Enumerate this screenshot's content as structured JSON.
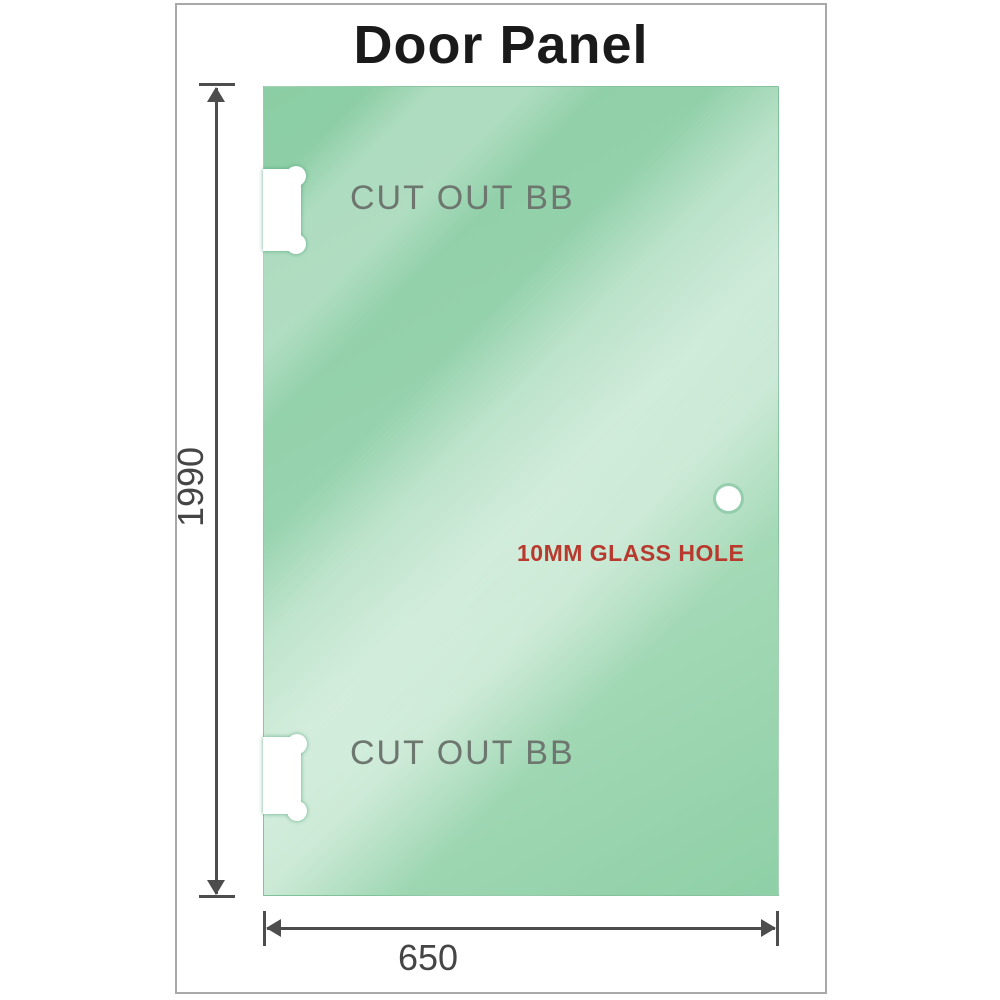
{
  "title": "Door Panel",
  "panel": {
    "cutout_top_label": "CUT OUT BB",
    "cutout_bottom_label": "CUT OUT BB",
    "hole_label": "10MM GLASS HOLE"
  },
  "dimensions": {
    "height": "1990",
    "width": "650"
  },
  "icons": {
    "dimension_arrows": [
      "arrow-up-icon",
      "arrow-down-icon",
      "arrow-left-icon",
      "arrow-right-icon"
    ]
  },
  "colors": {
    "glass_green_base": "#8bcda4",
    "glass_green_light": "#d2edda",
    "title_color": "#1a1a1a",
    "cutout_label_gray": "#6d766f",
    "hole_label_red": "#b83a2e",
    "dimension_gray": "#4d4d4d",
    "frame_border_gray": "#a9a9a9"
  }
}
